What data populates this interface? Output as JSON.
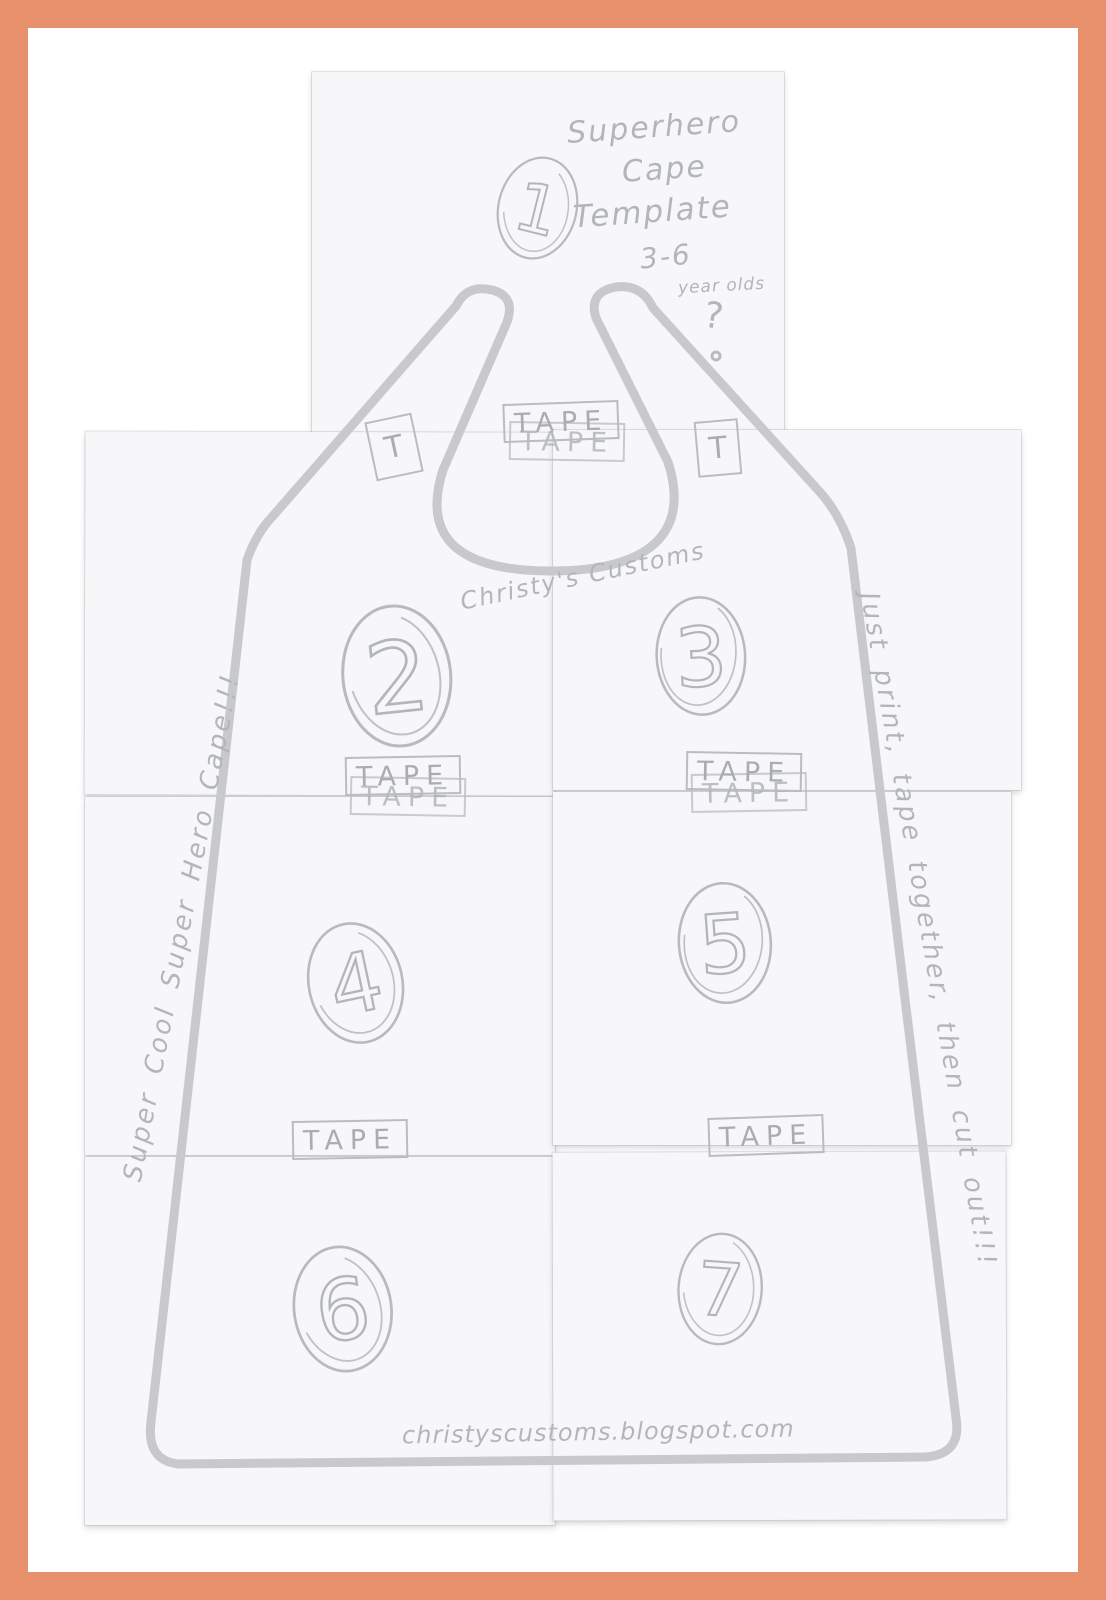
{
  "document": {
    "kind": "printable craft template scan",
    "title_lines": [
      "Superhero",
      "Cape",
      "Template"
    ],
    "age_range": "3-6",
    "age_unit": "year olds",
    "question_mark": "?",
    "brand": "Christy's Customs",
    "url": "christyscustoms.blogspot.com",
    "left_note": "Super Cool Super Hero Cape!!!",
    "right_note": "Just print, tape together, then cut out!!!"
  },
  "labels": {
    "tape": "TAPE",
    "tape_short": "T"
  },
  "sheets": [
    {
      "number": "1"
    },
    {
      "number": "2"
    },
    {
      "number": "3"
    },
    {
      "number": "4"
    },
    {
      "number": "5"
    },
    {
      "number": "6"
    },
    {
      "number": "7"
    }
  ],
  "colors": {
    "frame": "#E8906C",
    "background": "#FFFFFF",
    "paper": "#F7F7F9",
    "pencil_line": "#C7C9CC",
    "pencil_text": "#B2B6BA"
  }
}
